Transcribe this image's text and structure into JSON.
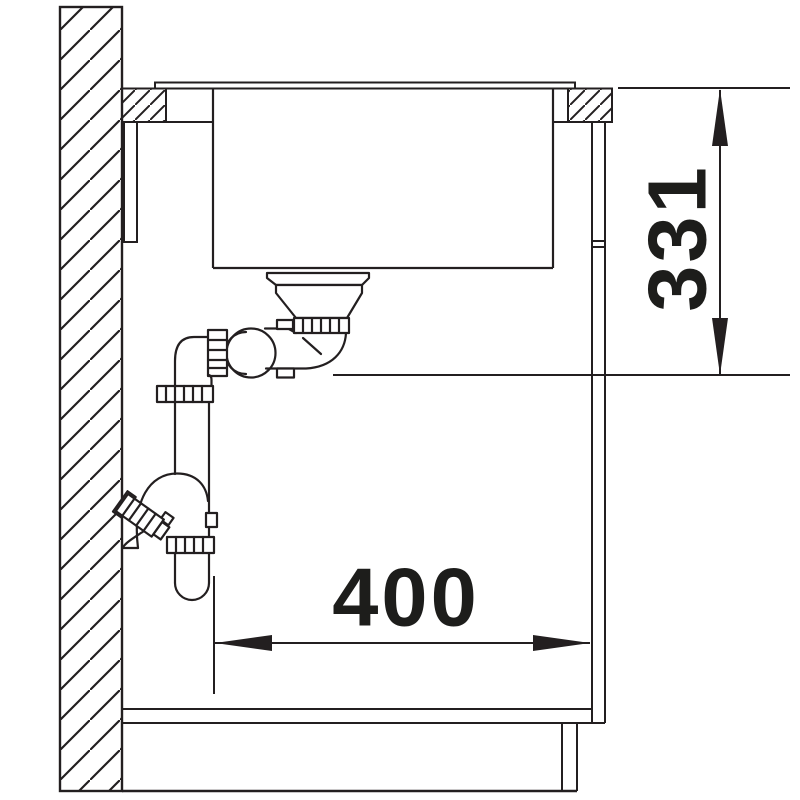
{
  "diagram": {
    "dimension_vertical": {
      "value": "331",
      "orientation": "vertical",
      "unit": "mm"
    },
    "dimension_horizontal": {
      "value": "400",
      "orientation": "horizontal",
      "unit": "mm"
    },
    "line_color": "#231f20",
    "text_color": "#1d1d1b",
    "background": "#ffffff",
    "components": [
      "wall",
      "countertop",
      "undermount-sink-basin",
      "strainer-drain",
      "siphon-trap",
      "wall-outlet-fitting",
      "cabinet-side-panel",
      "cabinet-bottom",
      "plinth"
    ]
  }
}
